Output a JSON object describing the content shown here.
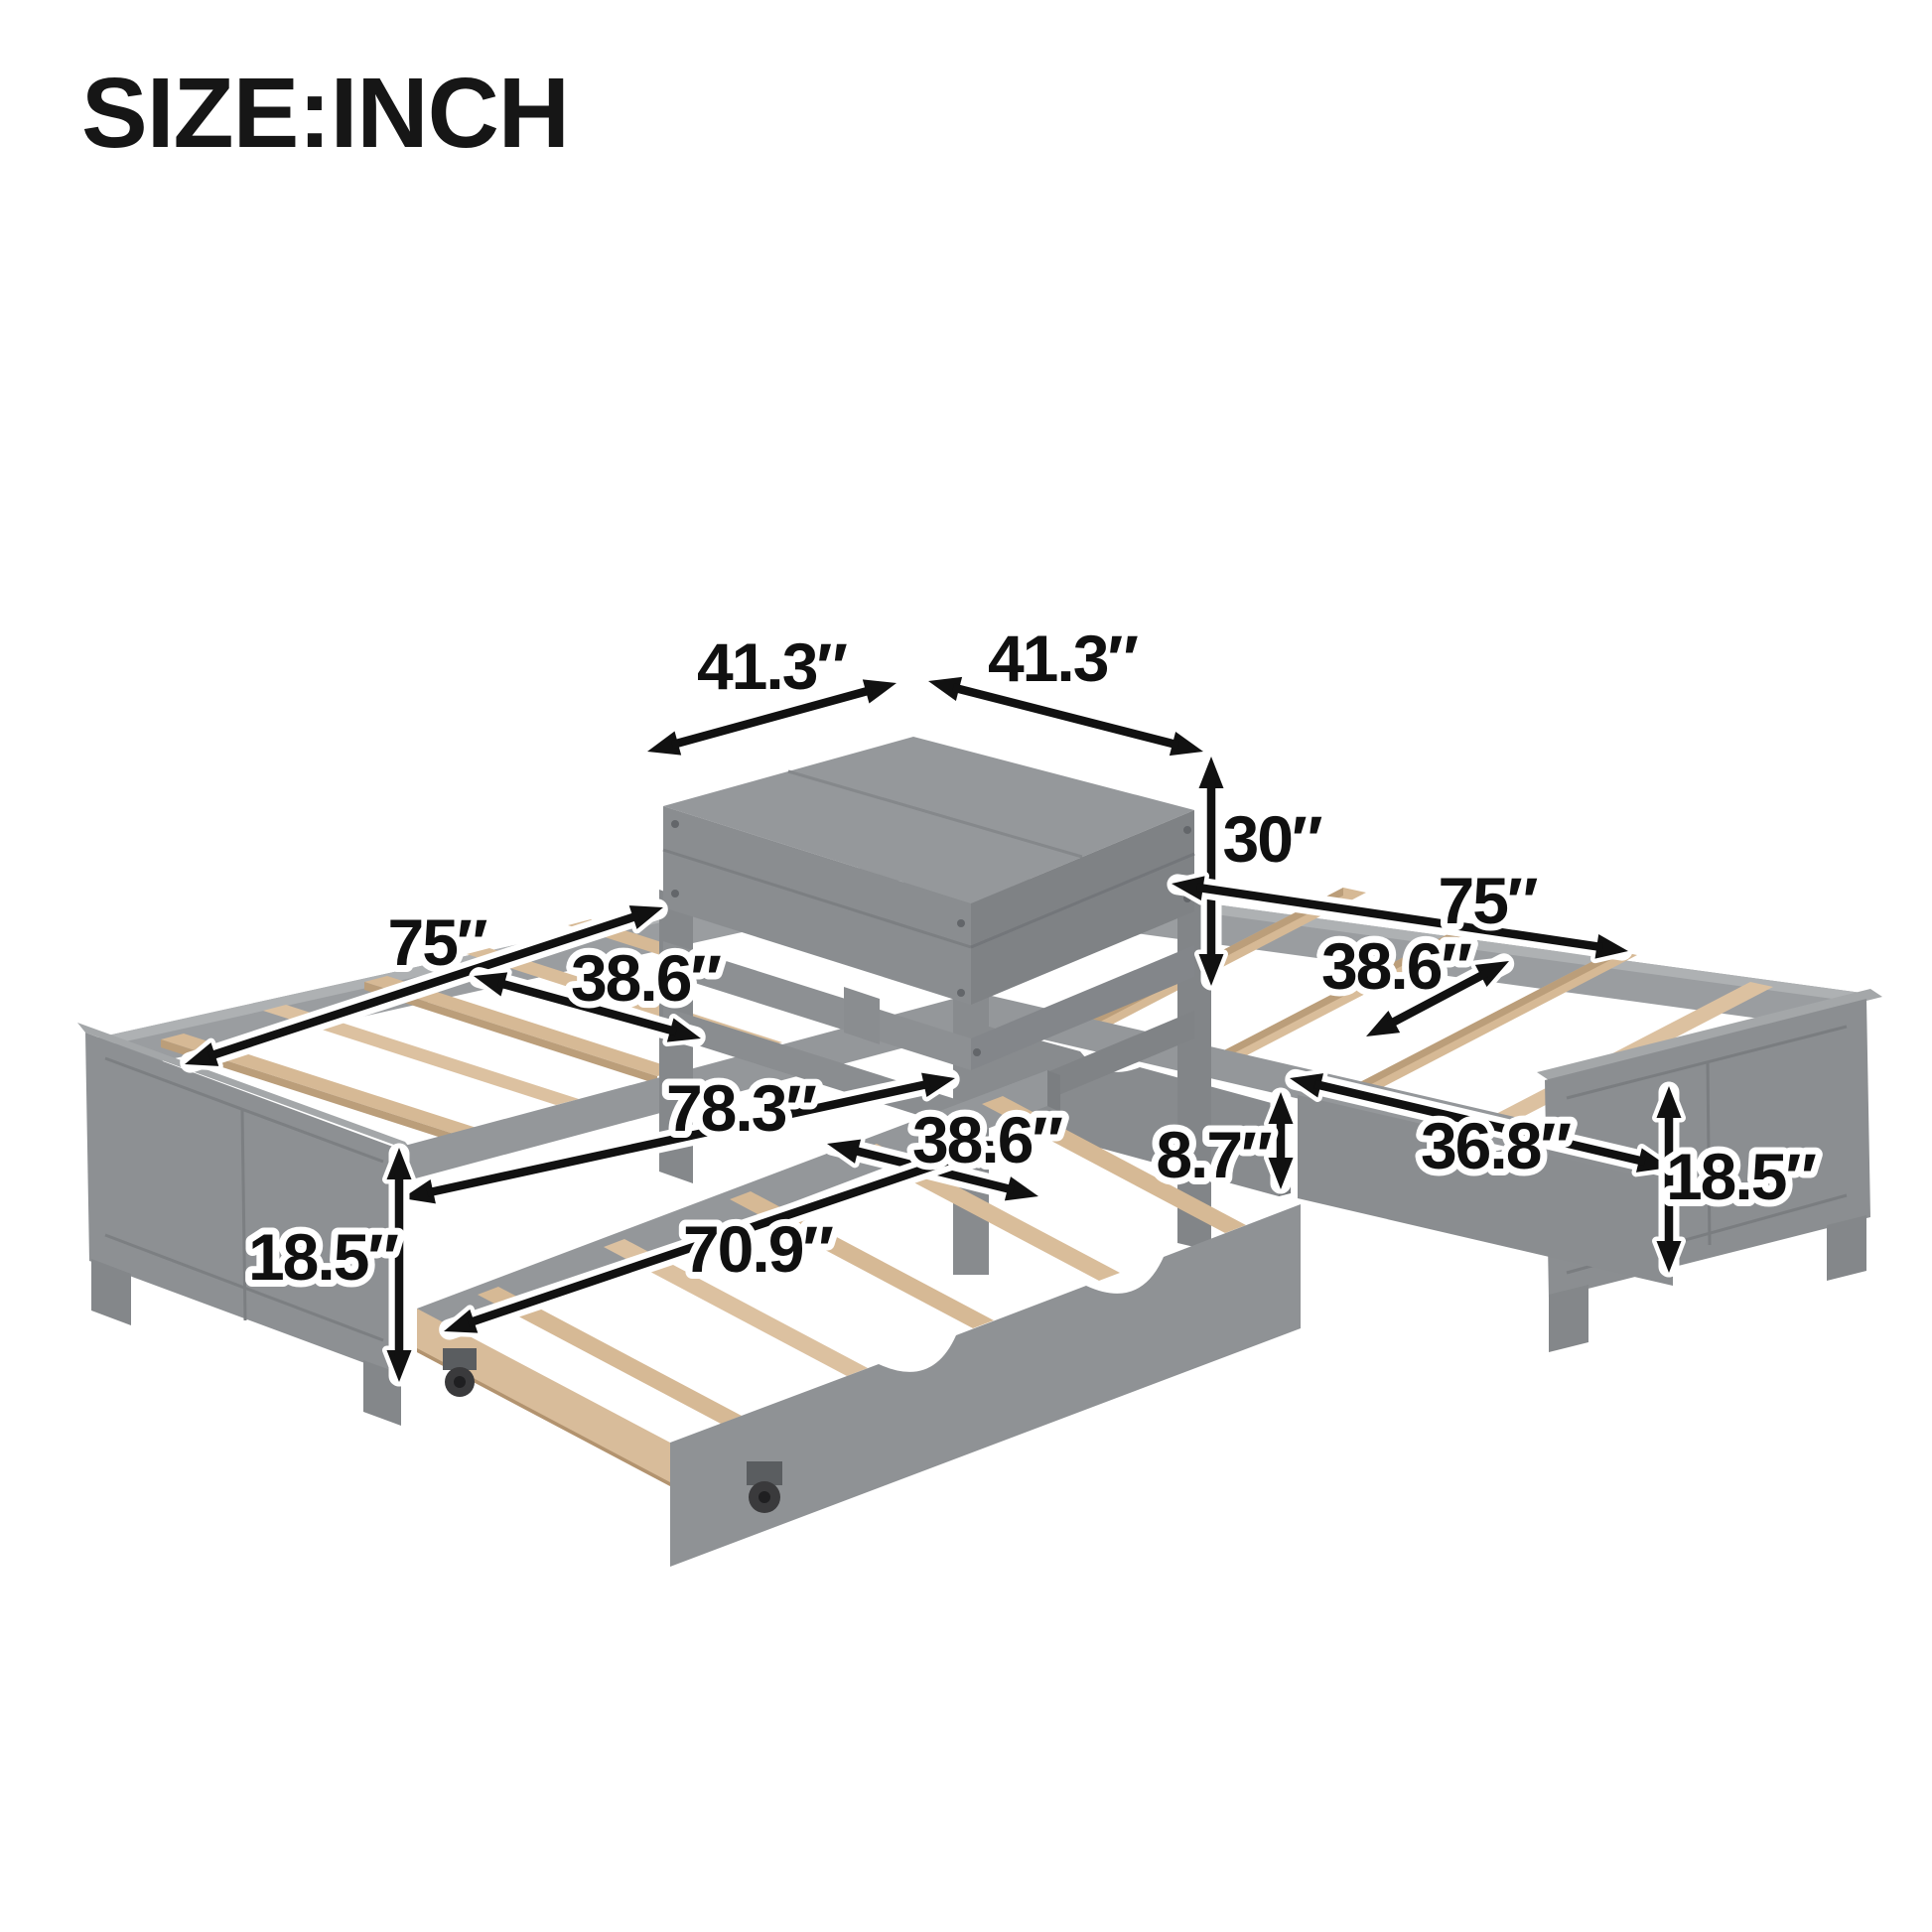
{
  "title": "SIZE:INCH",
  "diagram": {
    "subject": "L-shaped corner twin bed set with square corner table, pull-out trundle and storage drawer",
    "unit": "inch",
    "labels": {
      "platform_width_left": "41.3″",
      "platform_width_right": "41.3″",
      "platform_height": "30″",
      "left_bed_length": "75″",
      "left_bed_width": "38.6″",
      "right_bed_length": "75″",
      "right_bed_width": "38.6″",
      "overall_trundle_length": "78.3″",
      "trundle_width": "38.6″",
      "trundle_height": "8.7″",
      "drawer_length": "36.8″",
      "trundle_length": "70.9″",
      "left_footboard_height": "18.5″",
      "right_footboard_height": "18.5″"
    },
    "colors": {
      "frame_gray": "#8f9295",
      "frame_gray_dark": "#7f8285",
      "frame_gray_light": "#9a9da0",
      "slat_wood": "#d6b995",
      "wheel": "#3a3a3c",
      "arrow": "#111111",
      "text": "#101010",
      "background": "#ffffff"
    }
  }
}
